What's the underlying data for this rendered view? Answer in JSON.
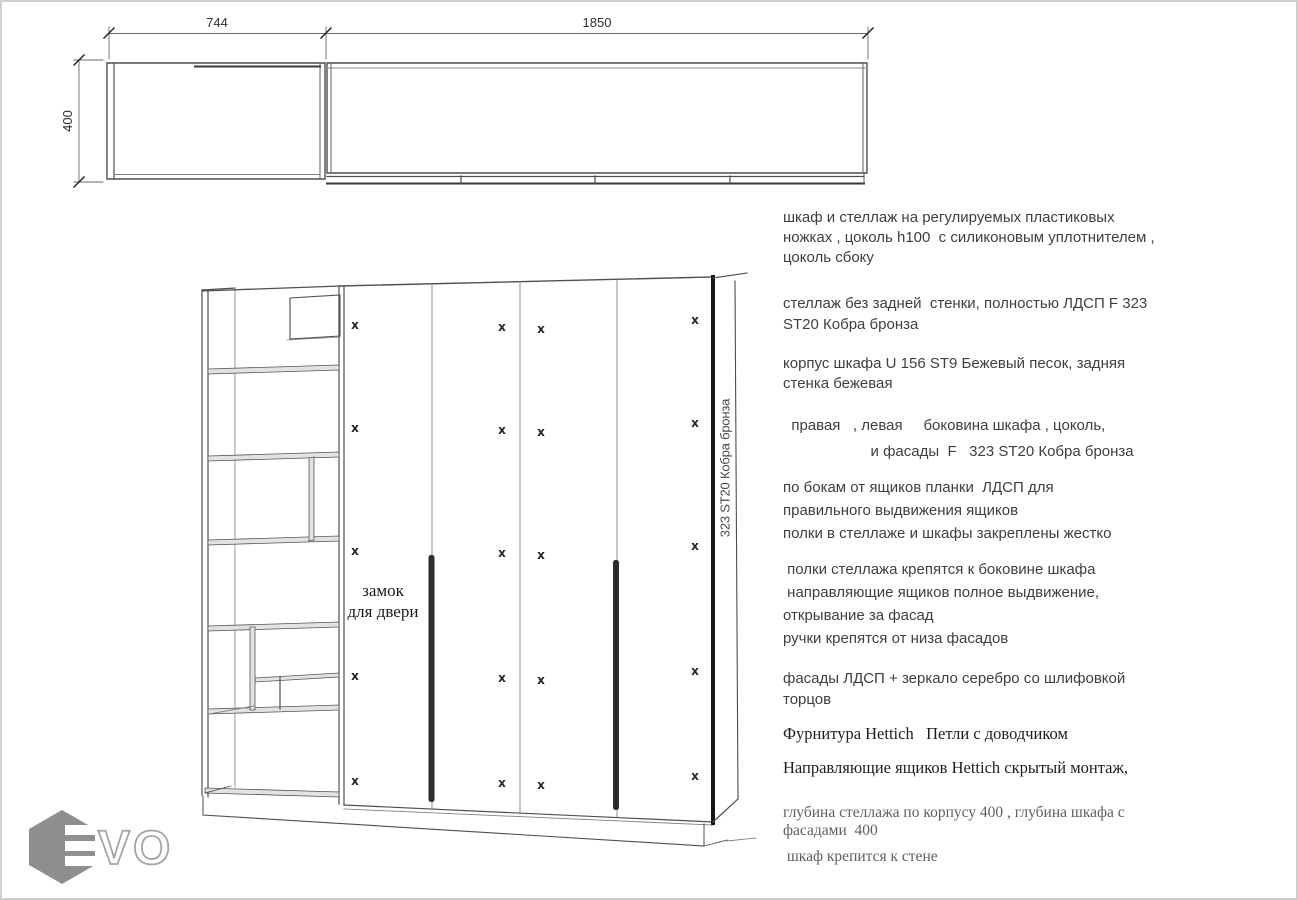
{
  "top_view": {
    "dim_left_width": "744",
    "dim_right_width": "1850",
    "dim_depth": "400"
  },
  "front_view": {
    "door_lock_label": "замок\nдля двери",
    "side_panel_label": "323 ST20 Кобра бронза",
    "hinge_mark": "x"
  },
  "notes": [
    "шкаф и стеллаж на регулируемых пластиковых\nножках , цоколь h100  с силиконовым уплотнителем ,\nцоколь сбоку",
    "стеллаж без задней  стенки, полностью ЛДСП F 323\nST20 Кобра бронза",
    "корпус шкафа U 156 ST9 Бежевый песок, задняя\nстенка бежевая",
    "  правая   , левая     боковина шкафа , цоколь,\n                     и фасады  F   323 ST20 Кобра бронза",
    "по бокам от ящиков планки  ЛДСП для\nправильного выдвижения ящиков\nполки в стеллаже и шкафы закреплены жестко",
    " полки стеллажа крепятся к боковине шкафа\n направляющие ящиков полное выдвижение,\nоткрывание за фасад\nручки крепятся от низа фасадов",
    "фасады ЛДСП + зеркало серебро со шлифовкой\nторцов",
    "Фурнитура Hettich   Петли с доводчиком",
    "Направляющие ящиков Hettich скрытый монтаж,",
    "глубина стеллажа по корпусу 400 , глубина шкафа с\nфасадами  400",
    " шкаф крепится к стене"
  ],
  "logo": {
    "text": "VO"
  },
  "colors": {
    "line": "#4f4f4f",
    "thick_edge": "#151515",
    "handle": "#2d2d2d",
    "shelf_fill": "#e2e2e2",
    "logo_gray": "#8e8e8e",
    "text": "#3f3f3f",
    "muted_text": "#5f5f5f"
  }
}
